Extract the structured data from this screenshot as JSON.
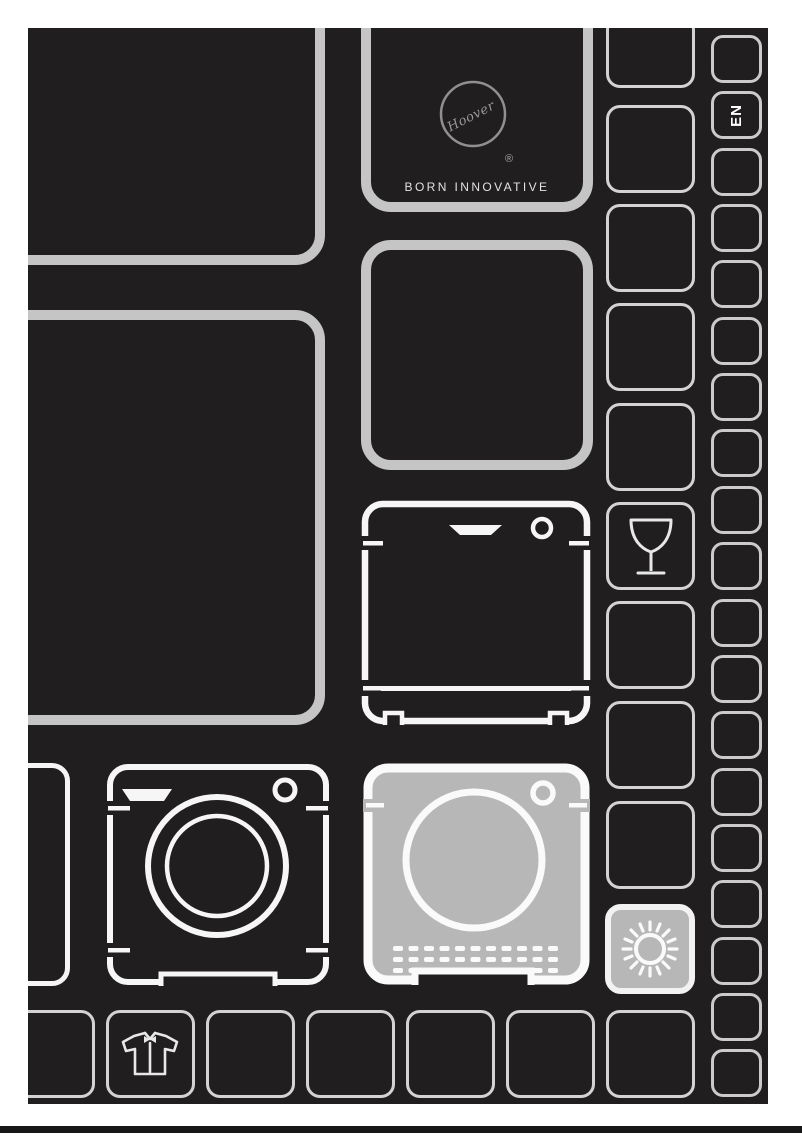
{
  "brand": {
    "logo_text": "Hoover",
    "registered_mark": "®",
    "tagline": "BORN INNOVATIVE"
  },
  "language_badge": {
    "label": "EN",
    "strip_index": 1
  },
  "cover": {
    "page_background": "#ffffff",
    "cover_background": "#211e1f",
    "bottom_edge_color": "#171717"
  },
  "palette": {
    "large_tile_border": "#c5c5c5",
    "small_tile_border": "#d3d3d3",
    "strip_tile_border": "#cbcbcb",
    "appliance_outline": "#f5f5f5",
    "highlight_fill": "#b7b7b7"
  },
  "icons": [
    "hoover-logo-icon",
    "wine-glass-icon",
    "washing-machine-icon",
    "tumble-dryer-icon",
    "dishwasher-icon",
    "sun-icon",
    "shirt-icon"
  ],
  "highlighted_appliance": "tumble-dryer",
  "decorative_grid": {
    "right_strip_tile_count": 19
  }
}
